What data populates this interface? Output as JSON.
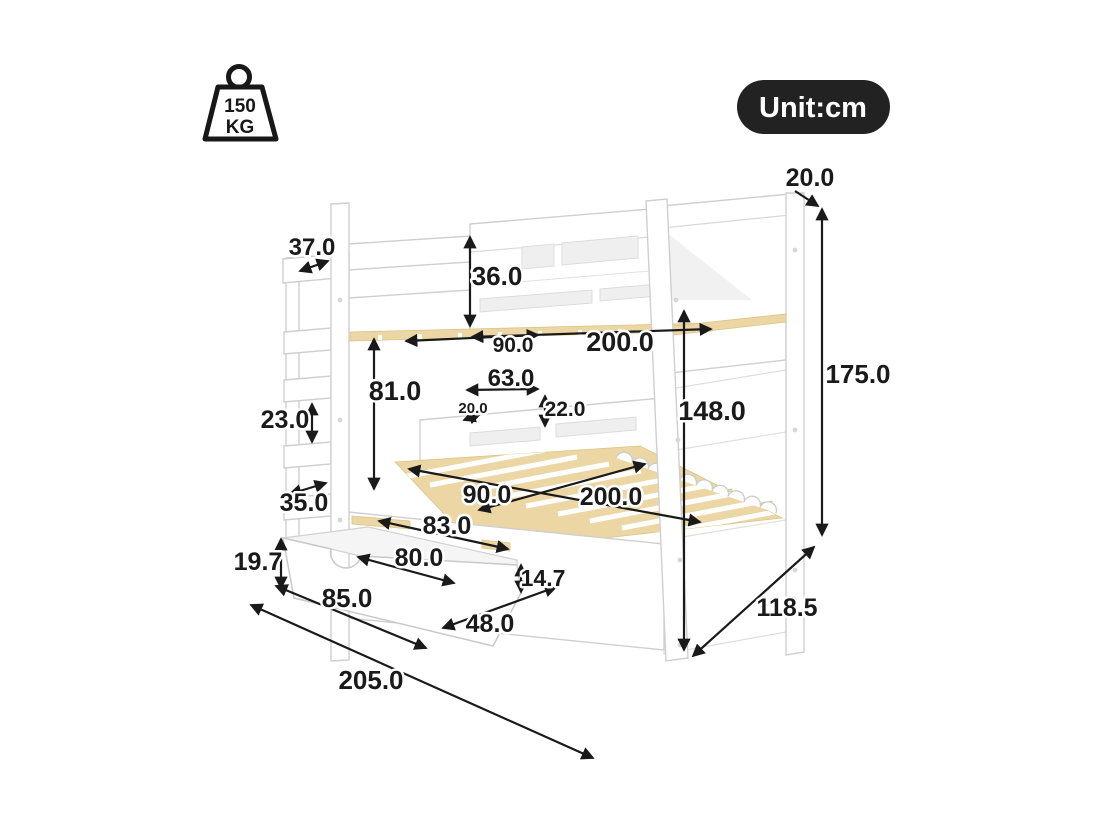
{
  "badges": {
    "weight_capacity": {
      "value": "150",
      "unit": "KG"
    },
    "unit_badge": "Unit:cm"
  },
  "colors": {
    "dimension_ink": "#1a1a1a",
    "badge_background": "#222222",
    "badge_text": "#ffffff",
    "slat_wood": "#ecd7a4",
    "bed_outline": "#cfcfcf"
  },
  "dimensions_cm": {
    "headboard_top_rail": "20.0",
    "ladder_top_depth": "37.0",
    "top_guardrail_height": "36.0",
    "top_bunk_width": "90.0",
    "top_bunk_length": "200.0",
    "bunk_clearance": "81.0",
    "headboard_shelf_length": "63.0",
    "headboard_shelf_height": "22.0",
    "headboard_shelf_depth": "20.0",
    "ladder_rung_spacing": "23.0",
    "ladder_base_depth": "35.0",
    "bottom_bunk_height": "148.0",
    "overall_height": "175.0",
    "bottom_bunk_width": "90.0",
    "bottom_bunk_length": "200.0",
    "drawer_opening_top": "83.0",
    "drawer_opening_width": "80.0",
    "drawer_front_height": "19.7",
    "drawer_side_height": "14.7",
    "drawer_front_length": "85.0",
    "drawer_depth": "48.0",
    "overall_length": "205.0",
    "overall_depth": "118.5"
  }
}
